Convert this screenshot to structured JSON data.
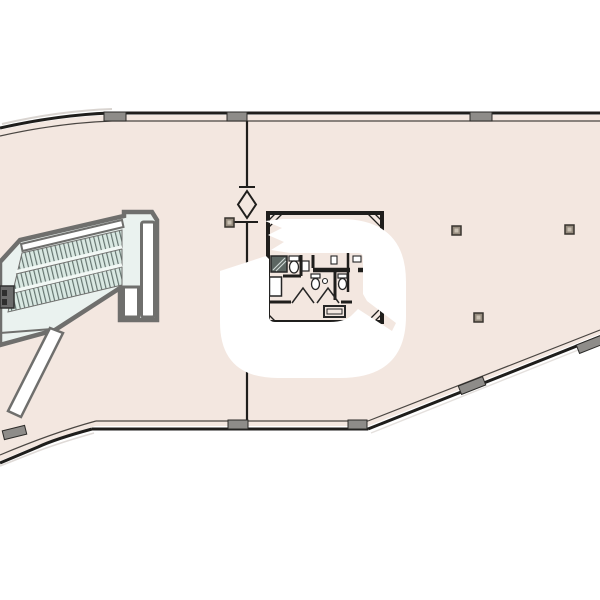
{
  "meta": {
    "page_type": "architectural floor plan drawing",
    "visible_text": "none"
  },
  "colors": {
    "canvas": "#ffffff",
    "floor": "#f3e7e0",
    "wall_dark": "#1f1e1c",
    "wall_inner": "#4a4642",
    "mullion_fill": "#8e8c89",
    "mullion_edge": "#2b2a28",
    "stair_fill": "#eaf2ef",
    "stair_wall": "#6f6f6d",
    "tread_fill": "#d9e8e2",
    "tread_line": "#63736e",
    "separator": "#f2f8f5",
    "fixture_outline": "#262626",
    "fixture_fill": "#ffffff",
    "stall_fill": "#5c6662",
    "column_fill": "#958b7e",
    "column_inner": "#c9c0b2",
    "watermark": "#ffffff",
    "shadow": "#c9c2bc"
  },
  "plan": {
    "columns": [
      {
        "x": 225,
        "y": 218
      },
      {
        "x": 452,
        "y": 226
      },
      {
        "x": 565,
        "y": 225
      },
      {
        "x": 474,
        "y": 313
      }
    ],
    "column_size": 9,
    "mullions": [
      {
        "x": 104,
        "y": 112,
        "w": 22,
        "r": 0
      },
      {
        "x": 227,
        "y": 112,
        "w": 20,
        "r": 0
      },
      {
        "x": 470,
        "y": 112,
        "w": 22,
        "r": 0
      },
      {
        "x": 228,
        "y": 420,
        "w": 20,
        "r": 0
      },
      {
        "x": 348,
        "y": 420,
        "w": 19,
        "r": 0
      },
      {
        "x": 459,
        "y": 381,
        "w": 26,
        "r": -21.5
      },
      {
        "x": 577,
        "y": 340,
        "w": 26,
        "r": -21.5
      },
      {
        "x": 3,
        "y": 428,
        "w": 23,
        "r": -14
      }
    ],
    "mullion_height": 9
  }
}
